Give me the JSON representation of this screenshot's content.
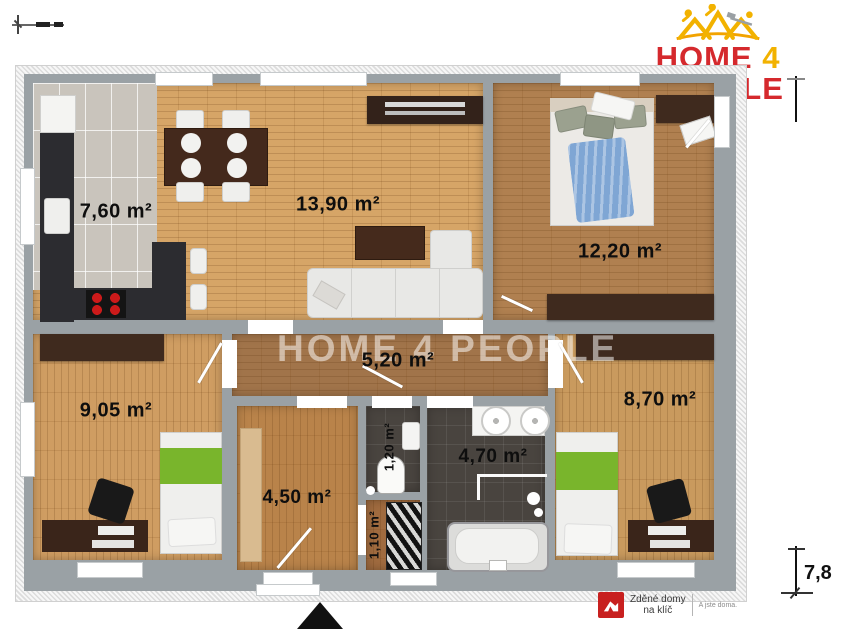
{
  "brand": {
    "word1": "HOME",
    "word2": "4",
    "word3": "PEOPLE"
  },
  "watermark_text": "HOME 4 PEOPLE",
  "rooms": [
    {
      "name": "kitchen",
      "area": "7,60 m²"
    },
    {
      "name": "living-room",
      "area": "13,90 m²"
    },
    {
      "name": "master-bedroom",
      "area": "12,20 m²"
    },
    {
      "name": "hallway",
      "area": "5,20 m²"
    },
    {
      "name": "bedroom-left",
      "area": "9,05 m²"
    },
    {
      "name": "bedroom-right",
      "area": "8,70 m²"
    },
    {
      "name": "entry-room",
      "area": "4,50 m²"
    },
    {
      "name": "wc",
      "area": "1,20 m²"
    },
    {
      "name": "closet",
      "area": "1,10 m²"
    },
    {
      "name": "bathroom",
      "area": "4,70 m²"
    }
  ],
  "dimensions": {
    "right_side": "7,8"
  },
  "footer_brand": {
    "line1": "Zděné domy",
    "line2": "na klíč",
    "tagline": "A jste doma."
  },
  "colors": {
    "brand_red": "#d5292d",
    "brand_yellow": "#f2b200",
    "wall_gray": "#9aa1a5"
  }
}
